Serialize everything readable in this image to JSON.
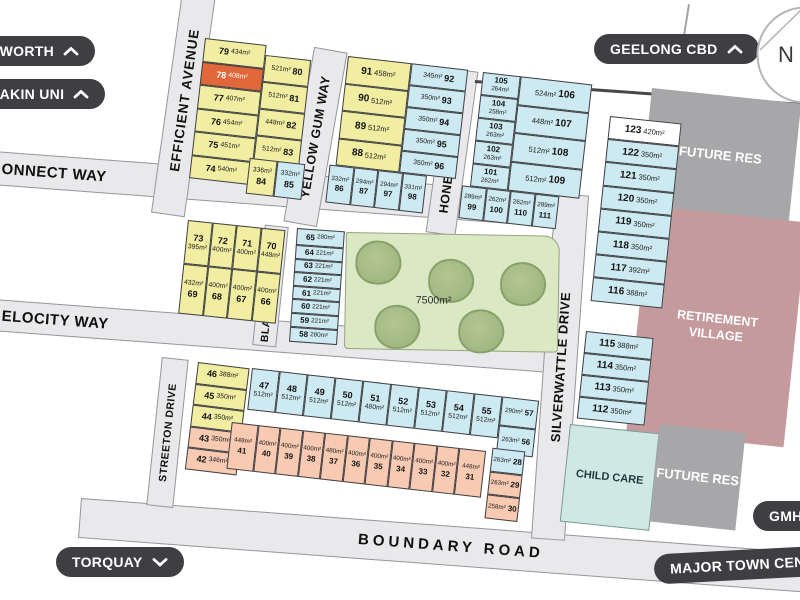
{
  "pills": {
    "pworth": {
      "label": "PWORTH",
      "chevron": "up"
    },
    "eakin_uni": {
      "label": "EAKIN UNI",
      "chevron": "up"
    },
    "geelong_cbd": {
      "label": "GEELONG CBD",
      "chevron": "up"
    },
    "torquay": {
      "label": "TORQUAY",
      "chevron": "down"
    },
    "gmhba": {
      "label": "GMHBA",
      "chevron": "none"
    },
    "major_town_centre": {
      "label": "MAJOR TOWN CENT",
      "chevron": "none"
    }
  },
  "compass": {
    "label": "N"
  },
  "streets": {
    "efficient_avenue": "EFFICIENT AVENUE",
    "yellow_gum_way": "YELLOW GUM WAY",
    "honeyeater_way": "HONEYEATER WAY",
    "silverwattle_drive": "SILVERWATTLE DRIVE",
    "blackwood_drive": "BLACKWOOD DRIVE",
    "streeton_drive": "STREETON DRIVE",
    "connect_way": "ONNECT WAY",
    "velocity_way": "ELOCITY WAY",
    "boundary_road": "BOUNDARY ROAD"
  },
  "areas": {
    "future_res_top": "FUTURE RES",
    "retirement_village": "RETIREMENT VILLAGE",
    "child_care": "CHILD CARE",
    "future_res_bottom": "FUTURE RES",
    "park_area": "7500m²"
  },
  "highlighted_lot": {
    "number": "78",
    "area": "408m²"
  },
  "colors": {
    "lot_yellow": "#f1eda1",
    "lot_blue": "#cde9f1",
    "lot_salmon": "#f8cab1",
    "lot_highlight_orange": "#e0673a",
    "park_green": "#dbe8c4",
    "tree_green": "#a9bd8b",
    "future_res_gray": "#a7a7a9",
    "retirement_pink": "#c49a9d",
    "child_care_teal": "#cfe8e4",
    "road_gray": "#e9e9eb",
    "pill_dark": "#3f3f43"
  },
  "lot_groups": {
    "a_col1": {
      "color": "y",
      "arr": "na-row",
      "cells": [
        {
          "n": "79",
          "a": "434m²"
        },
        {
          "n": "78",
          "a": "408m²",
          "c": "o"
        },
        {
          "n": "77",
          "a": "407m²"
        },
        {
          "n": "76",
          "a": "454m²"
        },
        {
          "n": "75",
          "a": "451m²"
        },
        {
          "n": "74",
          "a": "540m²"
        }
      ]
    },
    "a_col2": {
      "color": "y",
      "arr": "an-row",
      "cells": [
        {
          "n": "80",
          "a": "521m²"
        },
        {
          "n": "81",
          "a": "512m²"
        },
        {
          "n": "82",
          "a": "448m²"
        },
        {
          "n": "83",
          "a": "512m²"
        }
      ]
    },
    "a_pair": {
      "color": "y",
      "arr": "an-col",
      "cells": [
        {
          "n": "84",
          "a": "336m²"
        },
        {
          "n": "85",
          "a": "332m²",
          "c": "b"
        }
      ]
    },
    "b_col1": {
      "color": "y",
      "arr": "na-row",
      "cells": [
        {
          "n": "91",
          "a": "458m²"
        },
        {
          "n": "90",
          "a": "512m²"
        },
        {
          "n": "89",
          "a": "512m²"
        },
        {
          "n": "88",
          "a": "512m²"
        }
      ]
    },
    "b_col2": {
      "color": "b",
      "arr": "an-row",
      "cells": [
        {
          "n": "92",
          "a": "345m²"
        },
        {
          "n": "93",
          "a": "350m²"
        },
        {
          "n": "94",
          "a": "350m²"
        },
        {
          "n": "95",
          "a": "350m²"
        },
        {
          "n": "96",
          "a": "350m²"
        }
      ]
    },
    "b_bottom": {
      "color": "b",
      "arr": "an-col",
      "cells": [
        {
          "n": "86",
          "a": "332m²"
        },
        {
          "n": "87",
          "a": "294m²"
        },
        {
          "n": "97",
          "a": "294m²"
        },
        {
          "n": "98",
          "a": "331m²"
        }
      ]
    },
    "c_col1": {
      "color": "b",
      "arr": "na-col",
      "cells": [
        {
          "n": "105",
          "a": "264m²"
        },
        {
          "n": "104",
          "a": "258m²"
        },
        {
          "n": "103",
          "a": "263m²"
        },
        {
          "n": "102",
          "a": "263m²"
        },
        {
          "n": "101",
          "a": "262m²"
        }
      ]
    },
    "c_col2": {
      "color": "b",
      "arr": "an-row",
      "cells": [
        {
          "n": "106",
          "a": "524m²"
        },
        {
          "n": "107",
          "a": "448m²"
        },
        {
          "n": "108",
          "a": "512m²"
        },
        {
          "n": "109",
          "a": "512m²"
        }
      ]
    },
    "c_bottom": {
      "color": "b",
      "arr": "an-col",
      "cells": [
        {
          "n": "99",
          "a": "289m²"
        },
        {
          "n": "100",
          "a": "262m²"
        },
        {
          "n": "110",
          "a": "262m²"
        },
        {
          "n": "111",
          "a": "289m²"
        }
      ]
    },
    "d_upper": {
      "color": "b",
      "arr": "na-row",
      "cells": [
        {
          "n": "123",
          "a": "420m²",
          "c": "w"
        },
        {
          "n": "122",
          "a": "350m²"
        },
        {
          "n": "121",
          "a": "350m²"
        },
        {
          "n": "120",
          "a": "350m²"
        },
        {
          "n": "119",
          "a": "350m²"
        },
        {
          "n": "118",
          "a": "350m²"
        },
        {
          "n": "117",
          "a": "392m²"
        },
        {
          "n": "116",
          "a": "388m²"
        }
      ]
    },
    "d_lower": {
      "color": "b",
      "arr": "na-row",
      "cells": [
        {
          "n": "115",
          "a": "388m²"
        },
        {
          "n": "114",
          "a": "350m²"
        },
        {
          "n": "113",
          "a": "350m²"
        },
        {
          "n": "112",
          "a": "350m²"
        }
      ]
    },
    "e_row1": {
      "color": "y",
      "arr": "na-col",
      "cells": [
        {
          "n": "73",
          "a": "395m²"
        },
        {
          "n": "72",
          "a": "400m²"
        },
        {
          "n": "71",
          "a": "400m²"
        },
        {
          "n": "70",
          "a": "448m²"
        }
      ]
    },
    "e_row2": {
      "color": "y",
      "arr": "an-col",
      "cells": [
        {
          "n": "69",
          "a": "432m²"
        },
        {
          "n": "68",
          "a": "400m²"
        },
        {
          "n": "67",
          "a": "400m²"
        },
        {
          "n": "66",
          "a": "400m²"
        }
      ]
    },
    "f_strip": {
      "color": "b",
      "arr": "na-row",
      "cells": [
        {
          "n": "65",
          "a": "280m²"
        },
        {
          "n": "64",
          "a": "221m²"
        },
        {
          "n": "63",
          "a": "221m²"
        },
        {
          "n": "62",
          "a": "221m²"
        },
        {
          "n": "61",
          "a": "221m²"
        },
        {
          "n": "60",
          "a": "221m²"
        },
        {
          "n": "59",
          "a": "221m²"
        },
        {
          "n": "58",
          "a": "280m²"
        }
      ]
    },
    "g_col": {
      "color": "y",
      "arr": "na-row",
      "cells": [
        {
          "n": "46",
          "a": "388m²"
        },
        {
          "n": "45",
          "a": "350m²"
        },
        {
          "n": "44",
          "a": "350m²"
        },
        {
          "n": "43",
          "a": "350m²",
          "c": "s"
        },
        {
          "n": "42",
          "a": "346m²",
          "c": "s"
        }
      ]
    },
    "h_row1": {
      "color": "b",
      "arr": "na-col",
      "cells": [
        {
          "n": "47",
          "a": "512m²"
        },
        {
          "n": "48",
          "a": "512m²"
        },
        {
          "n": "49",
          "a": "512m²"
        },
        {
          "n": "50",
          "a": "512m²"
        },
        {
          "n": "51",
          "a": "480m²"
        },
        {
          "n": "52",
          "a": "512m²"
        },
        {
          "n": "53",
          "a": "512m²"
        },
        {
          "n": "54",
          "a": "512m²"
        },
        {
          "n": "55",
          "a": "512m²"
        }
      ]
    },
    "h_stack1": {
      "color": "b",
      "arr": "an-row",
      "cells": [
        {
          "n": "57",
          "a": "290m²"
        },
        {
          "n": "56",
          "a": "263m²"
        }
      ]
    },
    "h_row2": {
      "color": "s",
      "arr": "an-col",
      "cells": [
        {
          "n": "41",
          "a": "448m²"
        },
        {
          "n": "40",
          "a": "400m²"
        },
        {
          "n": "39",
          "a": "400m²"
        },
        {
          "n": "38",
          "a": "400m²"
        },
        {
          "n": "37",
          "a": "480m²"
        },
        {
          "n": "36",
          "a": "400m²"
        },
        {
          "n": "35",
          "a": "400m²"
        },
        {
          "n": "34",
          "a": "400m²"
        },
        {
          "n": "33",
          "a": "400m²"
        },
        {
          "n": "32",
          "a": "400m²"
        },
        {
          "n": "31",
          "a": "448m²"
        }
      ]
    },
    "h_stack2": {
      "color": "s",
      "arr": "an-row",
      "cells": [
        {
          "n": "28",
          "a": "263m²",
          "c": "b"
        },
        {
          "n": "29",
          "a": "263m²"
        },
        {
          "n": "30",
          "a": "258m²"
        }
      ]
    }
  }
}
